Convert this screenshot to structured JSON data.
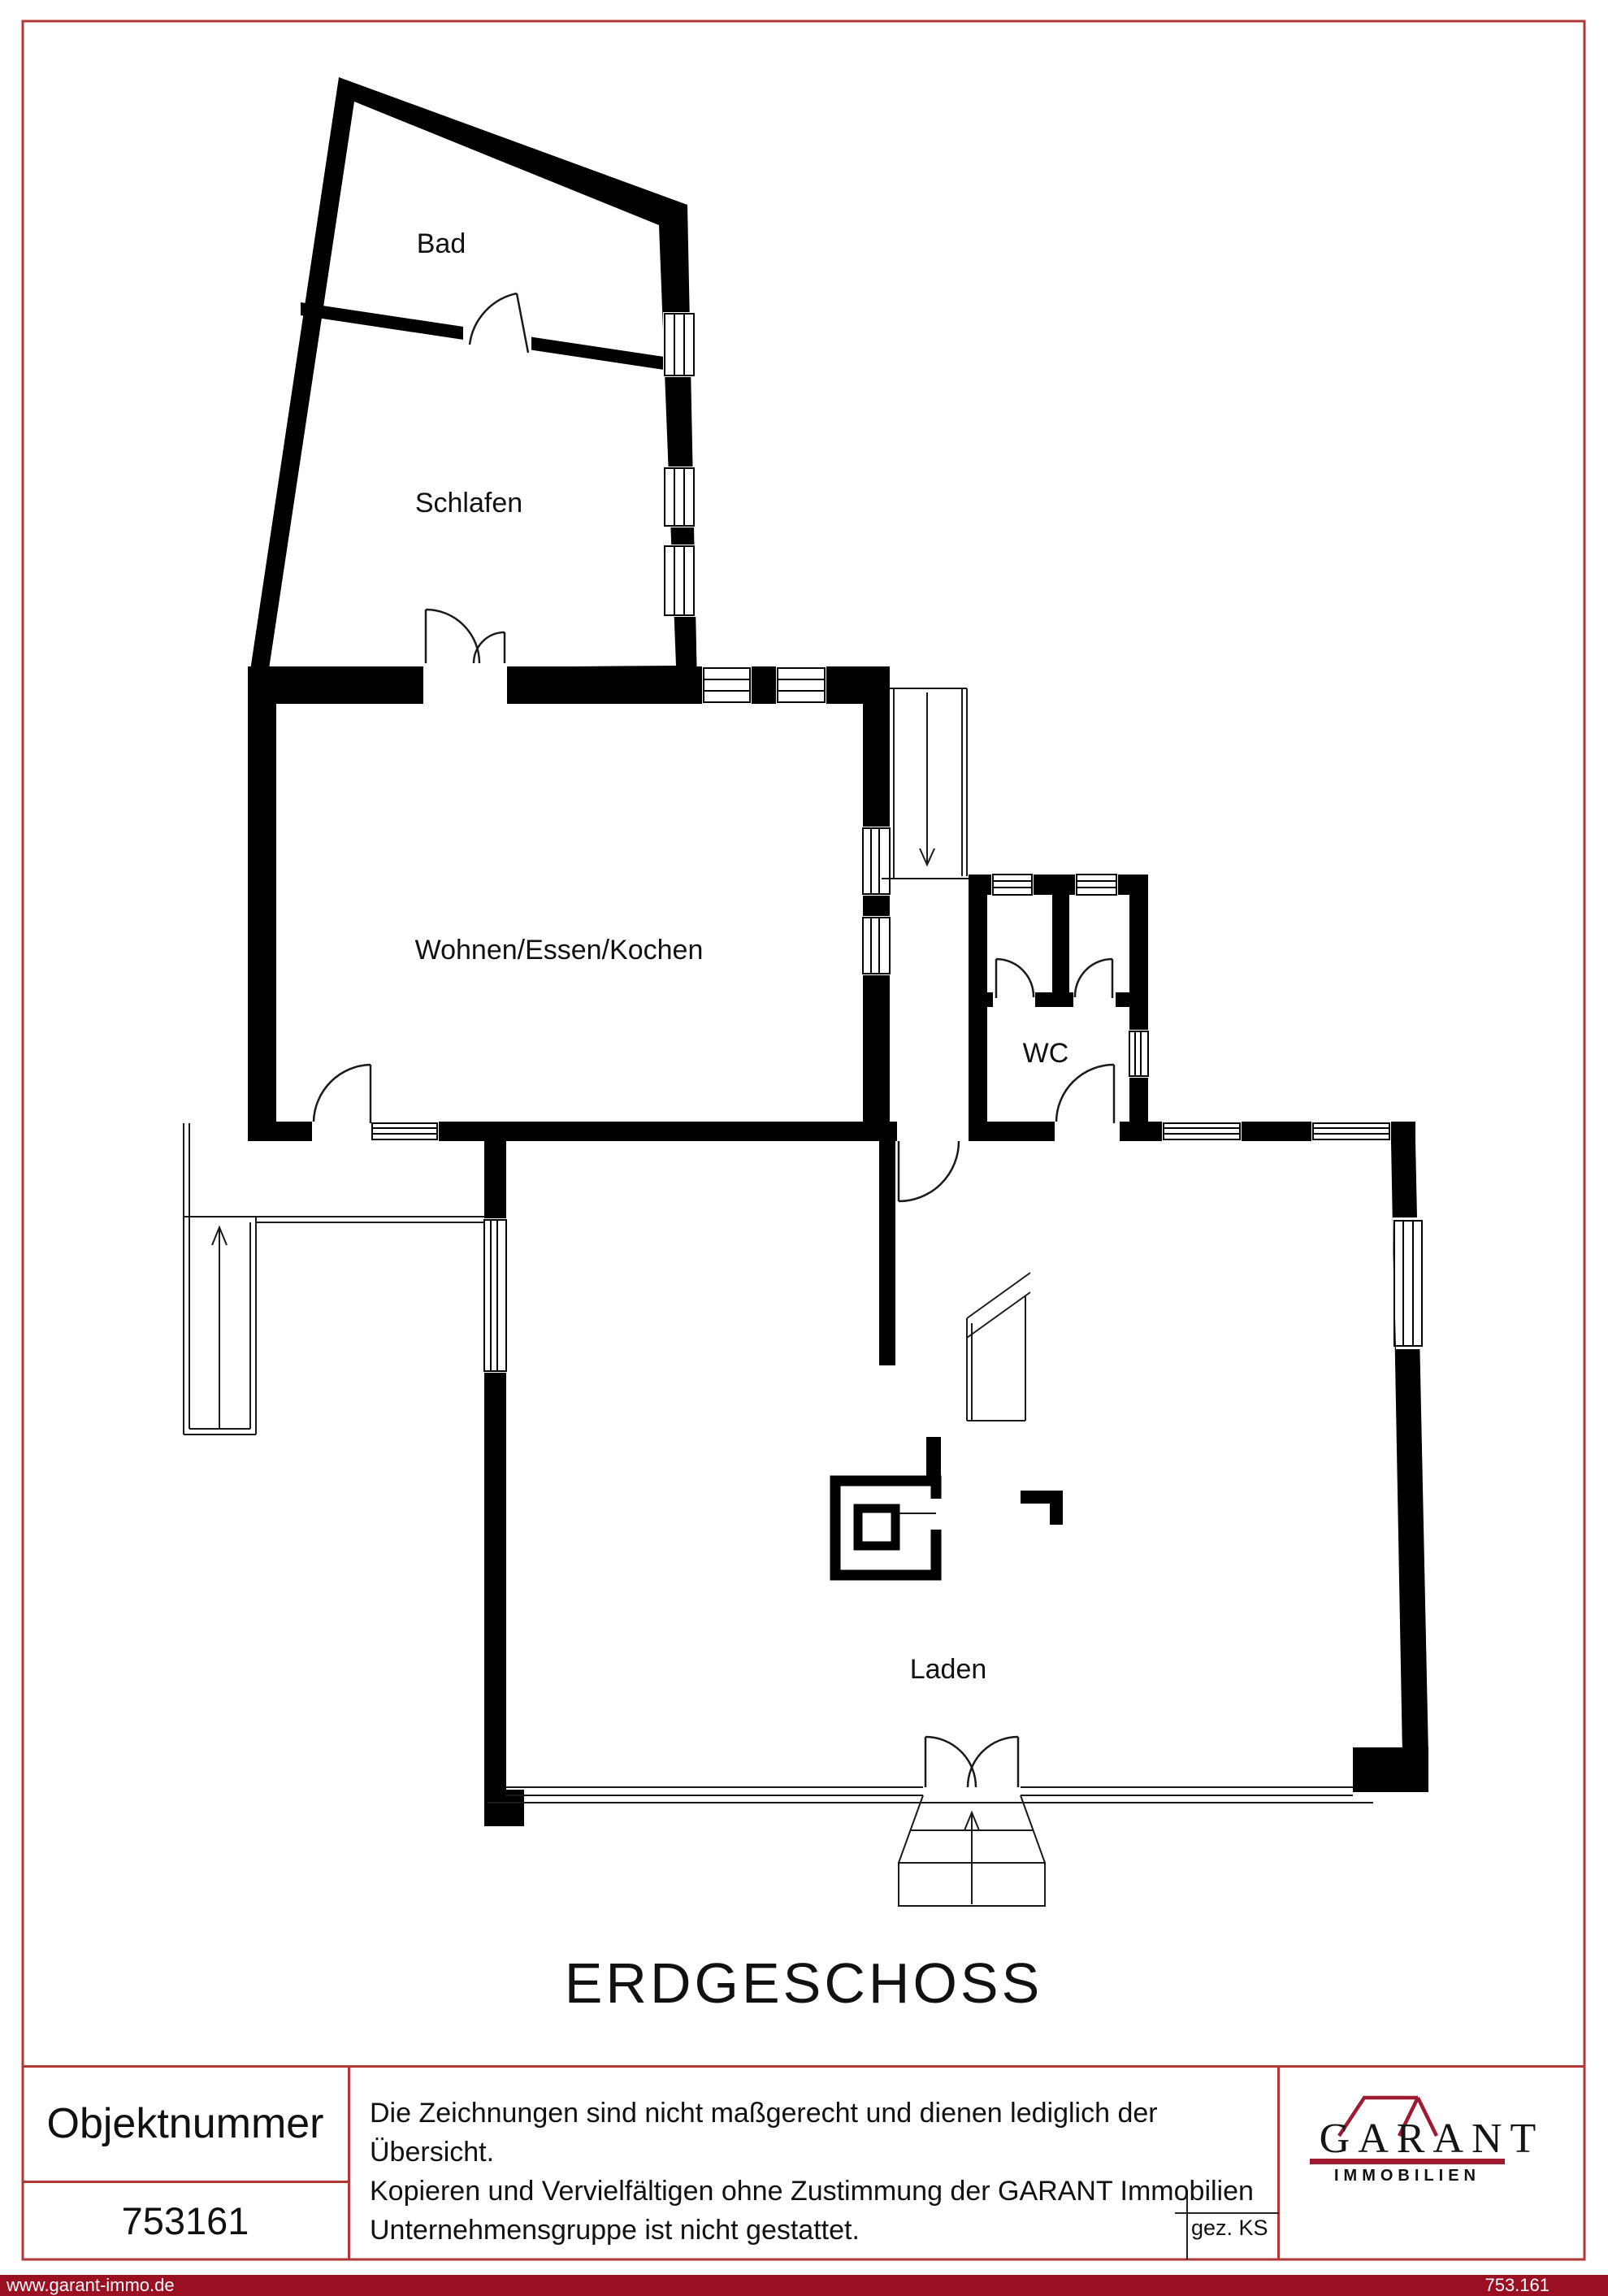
{
  "plan": {
    "title": "ERDGESCHOSS",
    "rooms": {
      "bad": "Bad",
      "schlafen": "Schlafen",
      "wohnen": "Wohnen/Essen/Kochen",
      "wc": "WC",
      "laden": "Laden"
    }
  },
  "footer": {
    "object_number_label": "Objektnummer",
    "object_number_value": "753161",
    "disclaimer_line1": "Die Zeichnungen sind nicht maßgerecht und dienen lediglich der Übersicht.",
    "disclaimer_line2": "Kopieren und Vervielfältigen ohne Zustimmung der GARANT Immobilien",
    "disclaimer_line3": "Unternehmensgruppe ist nicht gestattet.",
    "signature": "gez. KS",
    "logo_name": "GARANT",
    "logo_subtitle": "IMMOBILIEN"
  },
  "bottom_bar": {
    "website": "www.garant-immo.de",
    "reference": "753.161"
  },
  "colors": {
    "frame_red": "#b23737",
    "bar_red": "#9a0f22",
    "logo_red": "#9e1b32",
    "wall_black": "#000000"
  }
}
